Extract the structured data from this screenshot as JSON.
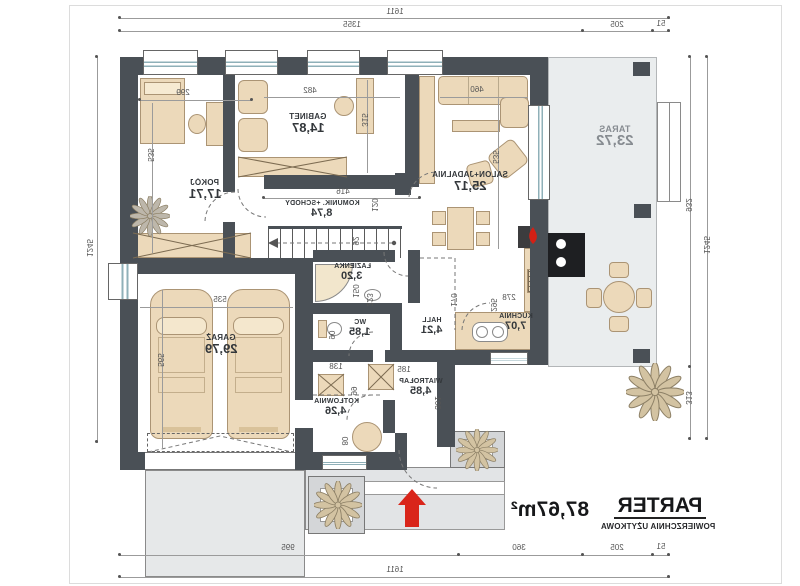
{
  "title": {
    "name": "PARTER",
    "subtitle": "POWIERZCHNIA UŻYTKOWA",
    "area": "87,67m²"
  },
  "rooms": [
    {
      "name": "POKÓJ",
      "area": "17,71"
    },
    {
      "name": "GABINET",
      "area": "14,87"
    },
    {
      "name": "SALON+JADALNIA",
      "area": "25,17"
    },
    {
      "name": "TARAS",
      "area": "23,72"
    },
    {
      "name": "KOMUNIK. +SCHODY",
      "area": "8,74"
    },
    {
      "name": "ŁAZIENKA",
      "area": "3,20"
    },
    {
      "name": "WC",
      "area": "1,85"
    },
    {
      "name": "HALL",
      "area": "4,21"
    },
    {
      "name": "KUCHNIA",
      "area": "7,07"
    },
    {
      "name": "GARAŻ",
      "area": "29,79"
    },
    {
      "name": "KOTŁOWNIA",
      "area": "4,26"
    },
    {
      "name": "WIATROŁAP",
      "area": "4,85"
    }
  ],
  "dimensions": {
    "top": {
      "total": "1611",
      "segments": [
        "1355",
        "205",
        "51"
      ]
    },
    "bottom": {
      "total": "1611",
      "segments": [
        "995",
        "360",
        "205",
        "51"
      ]
    },
    "left": {
      "total": "1245"
    },
    "right": {
      "total": "1245",
      "segments": [
        "932",
        "313"
      ]
    },
    "interior": {
      "pokoj_w": "299",
      "pokoj_h": "535",
      "gabinet_w": "482",
      "gabinet_h": "315",
      "salon_sofa": "460",
      "salon_h": "535",
      "komunik_w": "416",
      "komunik_d": "120",
      "stairs": "92",
      "garaz_w": "535",
      "garaz_h": "565",
      "lazienka_a": "150",
      "lazienka_b": "223",
      "wc_w": "90",
      "hall_w": "170",
      "kuchnia_w": "278",
      "kuchnia_h": "295",
      "wiatrolap_a": "185",
      "wiatrolap_b": "301",
      "kotlownia_a": "99",
      "kotlownia_b": "138",
      "boiler": "80"
    }
  },
  "colors": {
    "wall": "#4a5056",
    "furniture": "#ecd9ba",
    "terrace": "#eaedee",
    "glazing": "#8fb0b8",
    "arrow_red": "#d9251a"
  }
}
